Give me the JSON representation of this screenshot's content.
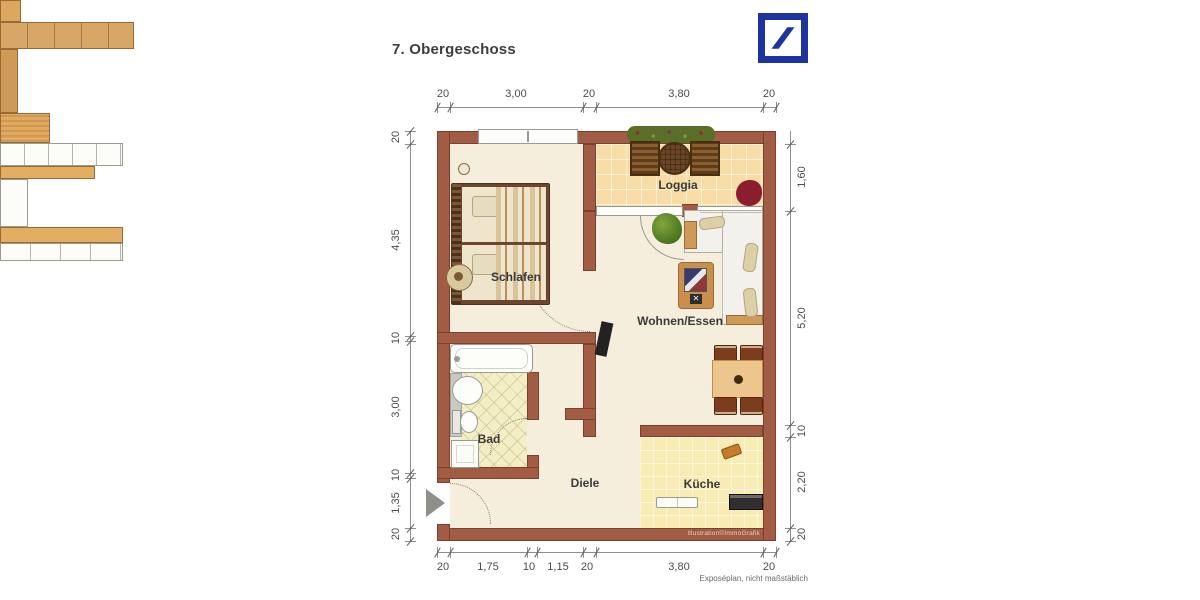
{
  "title": "7. Obergeschoss",
  "logo": {
    "name": "Deutsche Bank",
    "color": "#1e33a0"
  },
  "rooms": {
    "schlafen": "Schlafen",
    "loggia": "Loggia",
    "wohnen_essen": "Wohnen/Essen",
    "bad": "Bad",
    "diele": "Diele",
    "kueche": "Küche"
  },
  "dimensions": {
    "top": [
      "20",
      "3,00",
      "20",
      "3,80",
      "20"
    ],
    "left": [
      "20",
      "4,35",
      "10",
      "3,00",
      "10",
      "1,35",
      "20"
    ],
    "right": [
      "1,60",
      "5,20",
      "10",
      "2,20",
      "20"
    ],
    "bottom": [
      "20",
      "1,75",
      "10",
      "1,15",
      "20",
      "3,80",
      "20"
    ]
  },
  "footnote": "Exposéplan, nicht maßstäblich",
  "credit": "Illustration©ImmoGrafik",
  "colors": {
    "wall": "#a25c44",
    "floor": "#f5eedd",
    "loggia_tile": "#f8dca6",
    "kitchen_tile": "#f6ecb4",
    "bath_tile": "#f3eec6",
    "logo_blue": "#1e33a0"
  }
}
